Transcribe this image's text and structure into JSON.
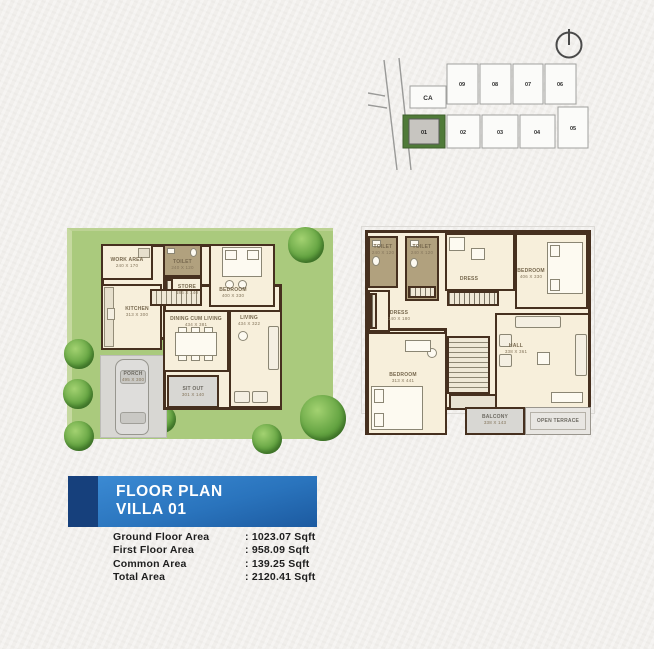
{
  "site_plan": {
    "common_area_label": "CA",
    "row_top": [
      "09",
      "08",
      "07",
      "06"
    ],
    "row_bottom": [
      "01",
      "02",
      "03",
      "04",
      "05"
    ],
    "highlighted_plot": "01",
    "highlight_color": "#4f7a38",
    "line_color": "#a0a09e"
  },
  "ground_floor": {
    "rooms": [
      {
        "name": "WORK AREA",
        "dims": "240 X 170"
      },
      {
        "name": "TOILET",
        "dims": "240 X 120"
      },
      {
        "name": "STORE",
        "dims": "186 X 140"
      },
      {
        "name": "BEDROOM",
        "dims": "400 X 330"
      },
      {
        "name": "KITCHEN",
        "dims": "313 X 300"
      },
      {
        "name": "DINING CUM LIVING",
        "dims": "434 X 381"
      },
      {
        "name": "LIVING",
        "dims": "434 X 322"
      },
      {
        "name": "SIT OUT",
        "dims": "301 X 140"
      },
      {
        "name": "PORCH",
        "dims": "495 X 300"
      }
    ]
  },
  "first_floor": {
    "rooms": [
      {
        "name": "TOILET",
        "dims": "240 X 120"
      },
      {
        "name": "TOILET",
        "dims": "240 X 120"
      },
      {
        "name": "DRESS",
        "dims": ""
      },
      {
        "name": "BEDROOM",
        "dims": "406 X 330"
      },
      {
        "name": "DRESS",
        "dims": "140 X 180"
      },
      {
        "name": "BEDROOM",
        "dims": "313 X 441"
      },
      {
        "name": "HALL",
        "dims": "338 X 361"
      },
      {
        "name": "BALCONY",
        "dims": "338 X 143"
      },
      {
        "name": "OPEN TERRACE",
        "dims": ""
      }
    ]
  },
  "banner": {
    "line1": "FLOOR PLAN",
    "line2": "VILLA 01",
    "stripe_color": "#16407c",
    "main_color": "#2a74bd"
  },
  "areas": {
    "rows": [
      {
        "label": "Ground Floor Area",
        "value": ": 1023.07 Sqft"
      },
      {
        "label": "First Floor Area",
        "value": ": 958.09 Sqft"
      },
      {
        "label": "Common Area",
        "value": ": 139.25 Sqft"
      },
      {
        "label": "Total Area",
        "value": ": 2120.41 Sqft"
      }
    ]
  }
}
